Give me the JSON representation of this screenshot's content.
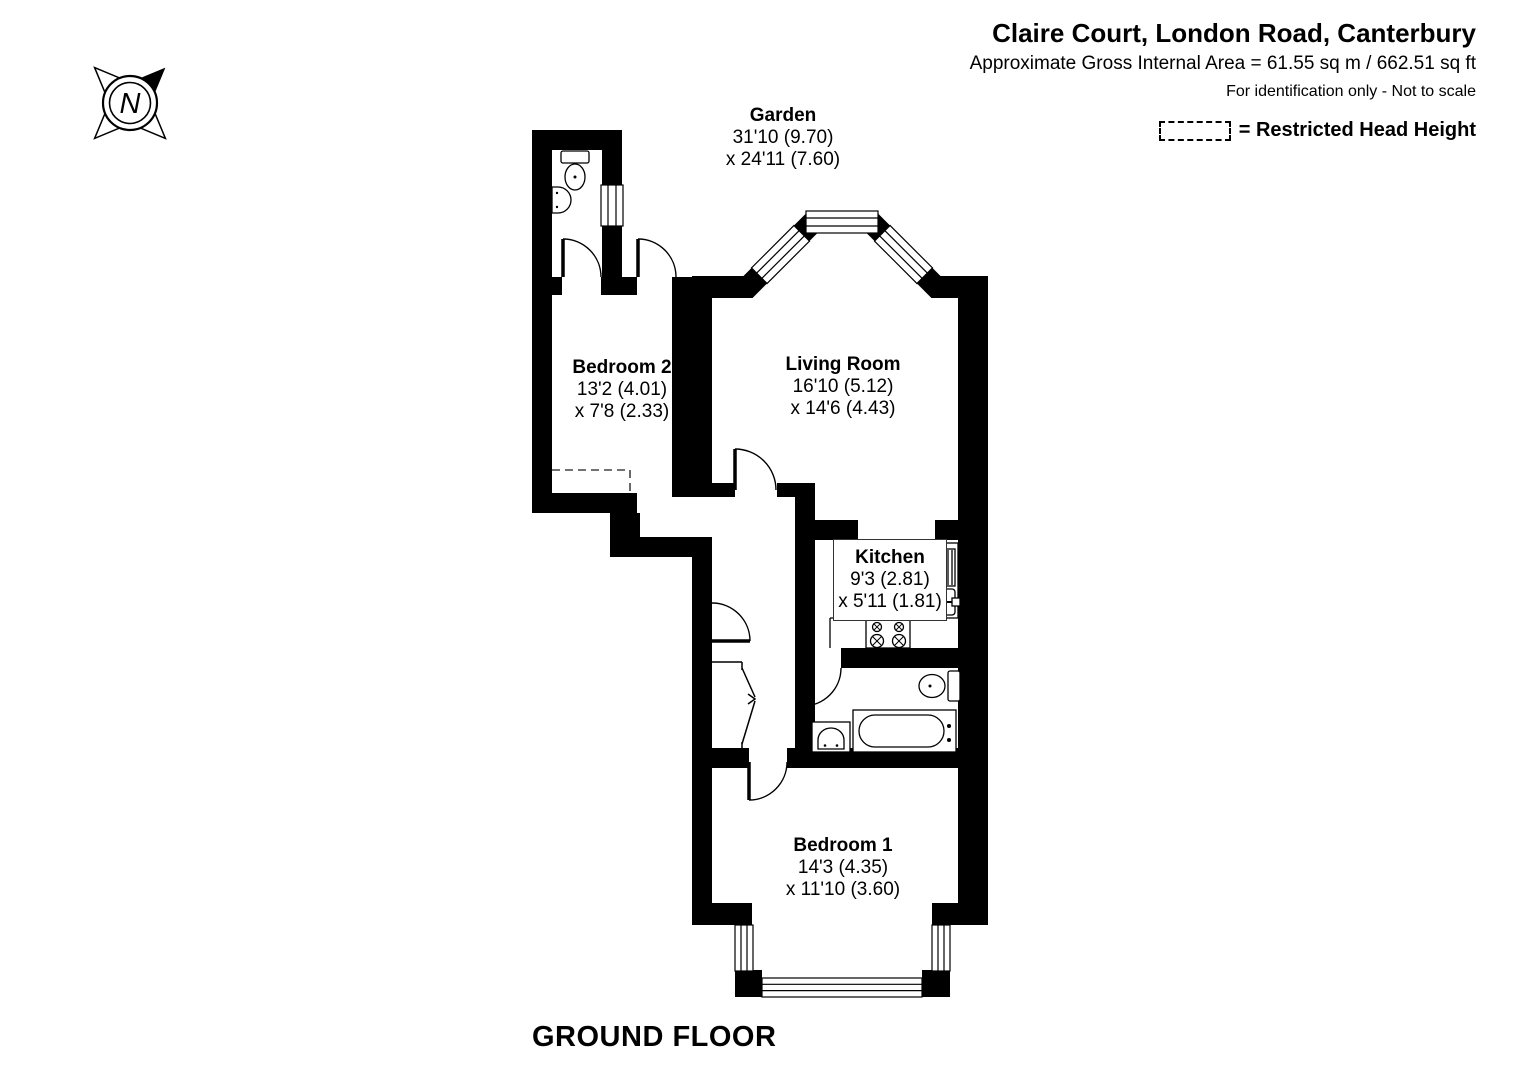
{
  "header": {
    "title": "Claire Court, London Road, Canterbury",
    "area": "Approximate Gross Internal Area = 61.55 sq m / 662.51 sq ft",
    "disclaimer": "For identification only - Not to scale",
    "legend_label": "= Restricted Head Height"
  },
  "compass": {
    "north_label": "N"
  },
  "rooms": {
    "garden": {
      "name": "Garden",
      "length": "31'10 (9.70)",
      "width": "x 24'11 (7.60)"
    },
    "bedroom2": {
      "name": "Bedroom 2",
      "length": "13'2 (4.01)",
      "width": "x 7'8 (2.33)"
    },
    "living_room": {
      "name": "Living Room",
      "length": "16'10 (5.12)",
      "width": "x 14'6 (4.43)"
    },
    "kitchen": {
      "name": "Kitchen",
      "length": "9'3 (2.81)",
      "width": "x 5'11 (1.81)"
    },
    "bedroom1": {
      "name": "Bedroom 1",
      "length": "14'3 (4.35)",
      "width": "x 11'10 (3.60)"
    }
  },
  "floor_label": "GROUND FLOOR",
  "colors": {
    "wall": "#000000",
    "background": "#ffffff",
    "dashed_line": "#444444"
  }
}
